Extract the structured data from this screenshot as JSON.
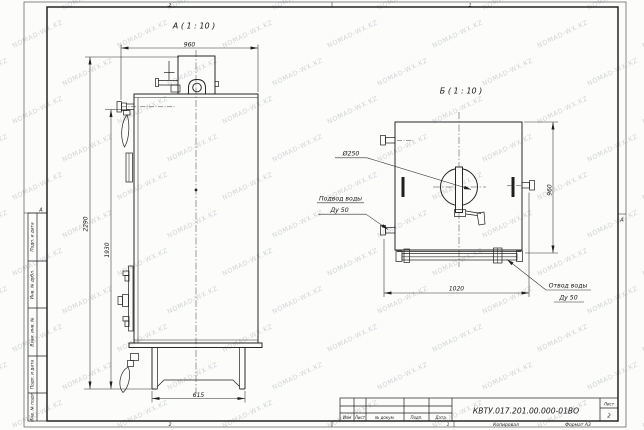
{
  "sheet": {
    "watermark_text": "NOMAD-WX.KZ",
    "zones": {
      "top_left": "2",
      "top_right": "1",
      "bottom_left": "2",
      "bottom_right": "1",
      "left": "А",
      "right": "А"
    }
  },
  "view_a": {
    "label": "А ( 1 : 10 )",
    "dim_width_top": "960",
    "dim_height_overall": "2290",
    "dim_height_body": "1930",
    "dim_base_width": "615"
  },
  "view_b": {
    "label": "Б ( 1 : 10 )",
    "dim_height": "960",
    "dim_pipe_span": "1020",
    "callout_flue": "Ø250",
    "callout_inlet_line1": "Подвод воды",
    "callout_inlet_line2": "Ду 50",
    "callout_outlet_line1": "Отвод воды",
    "callout_outlet_line2": "Ду 50"
  },
  "stamp_left": [
    "Подп. и дата",
    "Инв. № дубл.",
    "Взам. инв. №",
    "Подп. и дата",
    "Инв. № подл."
  ],
  "title_block": {
    "doc_number": "КВТУ.017.201.00.000-01ВО",
    "columns": [
      "Изм",
      "Лист",
      "№ докум.",
      "Подп.",
      "Дата"
    ],
    "sheet_label": "Лист",
    "sheet_value": "2",
    "footer_copy": "Копировал",
    "footer_format": "Формат А3"
  }
}
